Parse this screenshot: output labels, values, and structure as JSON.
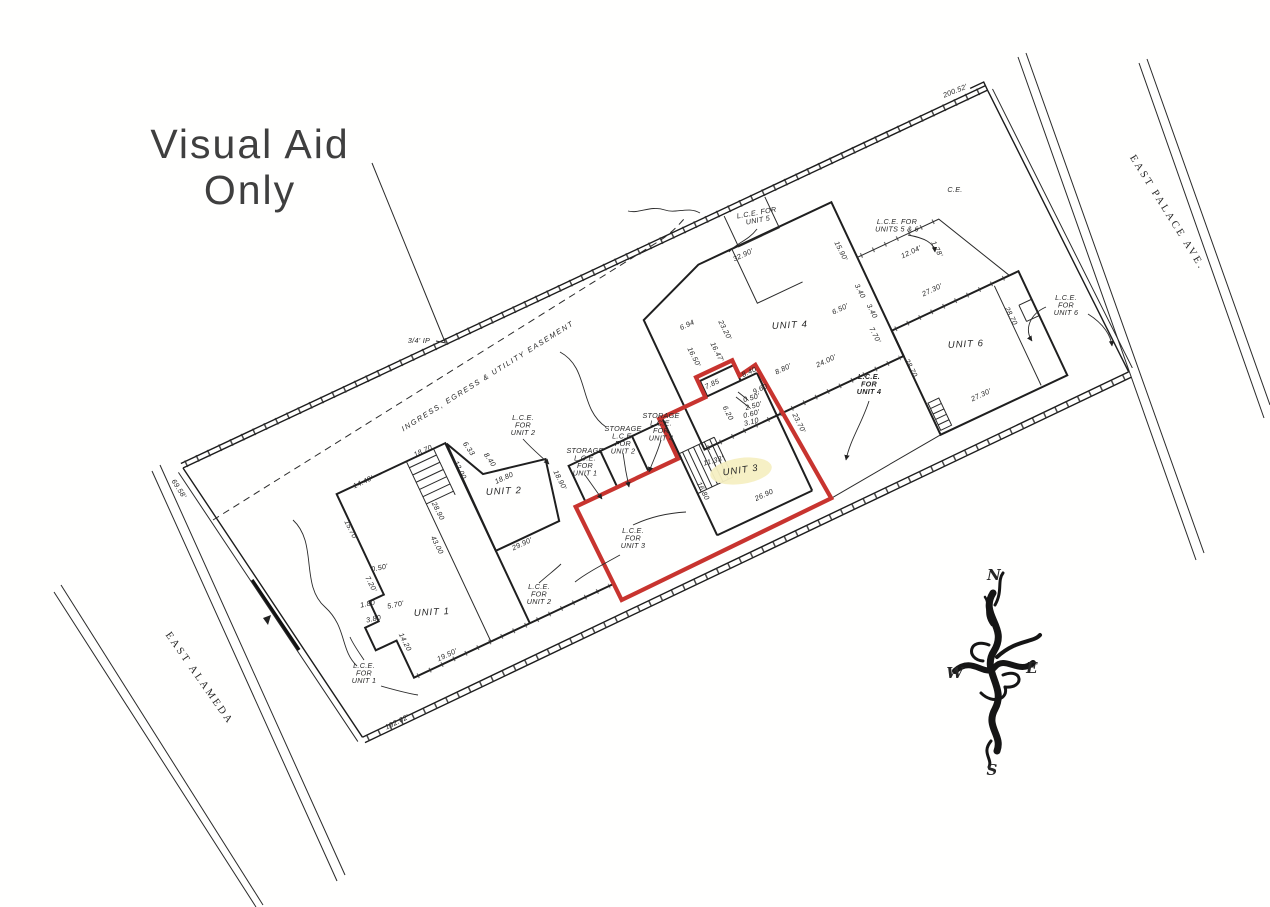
{
  "title": {
    "line1": "Visual Aid",
    "line2": "Only"
  },
  "colors": {
    "red_outline": "#c8342f",
    "unit3_highlight": "#f6efc2",
    "ink": "#1f1f1f"
  },
  "compass": {
    "n": "N",
    "e": "E",
    "s": "S",
    "w": "W"
  },
  "plan": {
    "texts": [
      {
        "n": "label-ce",
        "t": "C.E.",
        "x": 955,
        "y": 192,
        "r": 0,
        "s": 8
      },
      {
        "n": "label-lce-unit5",
        "lines": [
          "L.C.E. FOR",
          "UNIT 5"
        ],
        "x": 757,
        "y": 215,
        "r": -10
      },
      {
        "n": "label-lce-units-5-6",
        "lines": [
          "L.C.E. FOR",
          "UNITS 5 & 6"
        ],
        "x": 897,
        "y": 224,
        "r": 0
      },
      {
        "n": "label-lce-unit6",
        "lines": [
          "L.C.E.",
          "FOR",
          "UNIT 6"
        ],
        "x": 1066,
        "y": 300,
        "r": 0
      },
      {
        "n": "label-lce-unit4",
        "lines": [
          "L.C.E.",
          "FOR",
          "UNIT 4"
        ],
        "x": 869,
        "y": 379,
        "r": 0,
        "cls": "b"
      },
      {
        "n": "label-storage-unit4",
        "lines": [
          "STORAGE",
          "L.C.E.",
          "FOR",
          "UNIT 4"
        ],
        "x": 661,
        "y": 418,
        "r": 0
      },
      {
        "n": "label-storage-unit2",
        "lines": [
          "STORAGE",
          "L.C.E.",
          "FOR",
          "UNIT 2"
        ],
        "x": 623,
        "y": 431,
        "r": 0
      },
      {
        "n": "label-storage-unit1",
        "lines": [
          "STORAGE",
          "L.C.E.",
          "FOR",
          "UNIT 1"
        ],
        "x": 585,
        "y": 453,
        "r": 0
      },
      {
        "n": "label-lce-unit2-upper",
        "lines": [
          "L.C.E.",
          "FOR",
          "UNIT 2"
        ],
        "x": 523,
        "y": 420,
        "r": 0
      },
      {
        "n": "label-lce-unit3",
        "lines": [
          "L.C.E.",
          "FOR",
          "UNIT 3"
        ],
        "x": 633,
        "y": 533,
        "r": 0
      },
      {
        "n": "label-lce-unit2-lower",
        "lines": [
          "L.C.E.",
          "FOR",
          "UNIT 2"
        ],
        "x": 539,
        "y": 589,
        "r": 0
      },
      {
        "n": "label-lce-unit1",
        "lines": [
          "L.C.E.",
          "FOR",
          "UNIT 1"
        ],
        "x": 364,
        "y": 668,
        "r": 0
      },
      {
        "n": "label-unit1",
        "t": "UNIT 1",
        "x": 432,
        "y": 615,
        "r": -3,
        "cls": "u"
      },
      {
        "n": "label-unit2",
        "t": "UNIT 2",
        "x": 504,
        "y": 494,
        "r": -3,
        "cls": "u"
      },
      {
        "n": "label-unit3",
        "t": "UNIT 3",
        "x": 741,
        "y": 473,
        "r": -8,
        "cls": "u"
      },
      {
        "n": "label-unit4",
        "t": "UNIT 4",
        "x": 790,
        "y": 328,
        "r": -3,
        "cls": "u"
      },
      {
        "n": "label-unit6",
        "t": "UNIT 6",
        "x": 966,
        "y": 347,
        "r": -3,
        "cls": "u"
      },
      {
        "n": "label-easement",
        "t": "INGRESS, EGRESS & UTILITY EASEMENT",
        "x": 489,
        "y": 378,
        "r": -32,
        "cls": "e"
      },
      {
        "n": "label-iron-pipe",
        "t": "3/4' IP",
        "x": 419,
        "y": 343,
        "r": 0,
        "s": 8
      },
      {
        "n": "street-east-palace",
        "t": "EAST PALACE AVE.",
        "x": 1165,
        "y": 214,
        "r": 58,
        "cls": "st"
      },
      {
        "n": "street-east-alameda",
        "t": "EAST ALAMEDA",
        "x": 197,
        "y": 680,
        "r": 55,
        "cls": "st"
      },
      {
        "n": "compass-letter-n",
        "t": "N",
        "x": 994,
        "y": 580,
        "r": 0,
        "cls": "cp"
      },
      {
        "n": "compass-letter-w",
        "t": "W",
        "x": 955,
        "y": 678,
        "r": 0,
        "cls": "cp"
      },
      {
        "n": "compass-letter-e",
        "t": "E",
        "x": 1032,
        "y": 673,
        "r": 0,
        "cls": "cp"
      },
      {
        "n": "compass-letter-s",
        "t": "S",
        "x": 992,
        "y": 775,
        "r": 0,
        "cls": "cp"
      },
      {
        "n": "dim-boundary-north",
        "t": "200.52'",
        "x": 956,
        "y": 93,
        "r": -22,
        "s": 8
      },
      {
        "n": "dim-boundary-south",
        "t": "192.62'",
        "x": 398,
        "y": 724,
        "r": -26,
        "s": 8
      },
      {
        "n": "dim-boundary-west",
        "t": "69.58'",
        "x": 177,
        "y": 490,
        "r": 57,
        "s": 8
      },
      {
        "n": "dim",
        "t": "32.90'",
        "x": 744,
        "y": 257,
        "r": -25
      },
      {
        "n": "dim",
        "t": "15.90'",
        "x": 839,
        "y": 252,
        "r": 63
      },
      {
        "n": "dim",
        "t": "3.40",
        "x": 858,
        "y": 292,
        "r": 63,
        "s": 6.5
      },
      {
        "n": "dim",
        "t": "6.50'",
        "x": 841,
        "y": 311,
        "r": -25,
        "s": 6.5
      },
      {
        "n": "dim",
        "t": "3.40",
        "x": 870,
        "y": 312,
        "r": 63,
        "s": 6.5
      },
      {
        "n": "dim",
        "t": "7.70'",
        "x": 873,
        "y": 336,
        "r": 63,
        "s": 6.5
      },
      {
        "n": "dim",
        "t": "12.04'",
        "x": 912,
        "y": 254,
        "r": -25
      },
      {
        "n": "dim",
        "t": "1.78'",
        "x": 935,
        "y": 250,
        "r": 63,
        "s": 6.5
      },
      {
        "n": "dim",
        "t": "27.30'",
        "x": 933,
        "y": 292,
        "r": -25
      },
      {
        "n": "dim",
        "t": "28.70",
        "x": 909,
        "y": 369,
        "r": 63
      },
      {
        "n": "dim",
        "t": "28.70",
        "x": 1009,
        "y": 317,
        "r": 63
      },
      {
        "n": "dim",
        "t": "27.30'",
        "x": 982,
        "y": 397,
        "r": -25
      },
      {
        "n": "dim",
        "t": "6.94",
        "x": 688,
        "y": 327,
        "r": -25,
        "s": 6.5
      },
      {
        "n": "dim",
        "t": "23.20'",
        "x": 723,
        "y": 331,
        "r": 63
      },
      {
        "n": "dim",
        "t": "16.47'",
        "x": 715,
        "y": 353,
        "r": 63,
        "s": 6.5
      },
      {
        "n": "dim",
        "t": "16.50'",
        "x": 692,
        "y": 358,
        "r": 63,
        "s": 6.5
      },
      {
        "n": "dim",
        "t": "24.00'",
        "x": 827,
        "y": 363,
        "r": -25
      },
      {
        "n": "dim",
        "t": "8.80'",
        "x": 784,
        "y": 371,
        "r": -25,
        "s": 6.5
      },
      {
        "n": "dim",
        "t": "8.40",
        "x": 750,
        "y": 374,
        "r": -25,
        "s": 6.5
      },
      {
        "n": "dim",
        "t": "9.60",
        "x": 761,
        "y": 391,
        "r": -25,
        "s": 6.5
      },
      {
        "n": "dim",
        "t": "7.85",
        "x": 713,
        "y": 386,
        "r": -25,
        "s": 6.5
      },
      {
        "n": "dim",
        "t": "0.50'",
        "x": 752,
        "y": 400,
        "r": -15,
        "s": 6.2
      },
      {
        "n": "dim",
        "t": "2.50'",
        "x": 754,
        "y": 408,
        "r": -15,
        "s": 6.2
      },
      {
        "n": "dim",
        "t": "0.60'",
        "x": 752,
        "y": 416,
        "r": -15,
        "s": 6.2
      },
      {
        "n": "dim",
        "t": "3.10",
        "x": 752,
        "y": 424,
        "r": -15,
        "s": 6.2
      },
      {
        "n": "dim",
        "t": "6.20",
        "x": 726,
        "y": 414,
        "r": 63,
        "s": 6.5
      },
      {
        "n": "dim",
        "t": "23.70'",
        "x": 797,
        "y": 424,
        "r": 63
      },
      {
        "n": "dim",
        "t": "11.33'",
        "x": 714,
        "y": 463,
        "r": -15,
        "s": 6.5
      },
      {
        "n": "dim",
        "t": "16.80",
        "x": 701,
        "y": 492,
        "r": 63,
        "s": 6.5
      },
      {
        "n": "dim",
        "t": "26.90",
        "x": 765,
        "y": 497,
        "r": -25,
        "s": 6.5
      },
      {
        "n": "dim",
        "t": "18.70",
        "x": 424,
        "y": 453,
        "r": -25,
        "s": 6.5
      },
      {
        "n": "dim",
        "t": "6.33",
        "x": 467,
        "y": 450,
        "r": 55,
        "s": 6.5
      },
      {
        "n": "dim",
        "t": "12.00",
        "x": 458,
        "y": 471,
        "r": 63,
        "s": 6.5
      },
      {
        "n": "dim",
        "t": "8.40",
        "x": 488,
        "y": 461,
        "r": 55,
        "s": 6.5
      },
      {
        "n": "dim",
        "t": "18.80",
        "x": 505,
        "y": 480,
        "r": -25,
        "s": 6.5
      },
      {
        "n": "dim",
        "t": "18.90'",
        "x": 558,
        "y": 481,
        "r": 63,
        "s": 6.5
      },
      {
        "n": "dim",
        "t": "28.90",
        "x": 436,
        "y": 512,
        "r": 63,
        "s": 6.5
      },
      {
        "n": "dim",
        "t": "29.90'",
        "x": 523,
        "y": 546,
        "r": -25
      },
      {
        "n": "dim",
        "t": "43.00",
        "x": 435,
        "y": 546,
        "r": 63,
        "s": 6.5
      },
      {
        "n": "dim",
        "t": "14.40'",
        "x": 364,
        "y": 484,
        "r": -25
      },
      {
        "n": "dim",
        "t": "15.70'",
        "x": 349,
        "y": 531,
        "r": 63
      },
      {
        "n": "dim",
        "t": "0.50'",
        "x": 380,
        "y": 570,
        "r": -12,
        "s": 6.2
      },
      {
        "n": "dim",
        "t": "7.20'",
        "x": 369,
        "y": 585,
        "r": 63,
        "s": 6.2
      },
      {
        "n": "dim",
        "t": "1.80",
        "x": 368,
        "y": 606,
        "r": -12,
        "s": 6.2
      },
      {
        "n": "dim",
        "t": "5.70'",
        "x": 396,
        "y": 607,
        "r": -12,
        "s": 6.2
      },
      {
        "n": "dim",
        "t": "3.80",
        "x": 374,
        "y": 621,
        "r": -12,
        "s": 6.2
      },
      {
        "n": "dim",
        "t": "14.20",
        "x": 403,
        "y": 643,
        "r": 63,
        "s": 6.5
      },
      {
        "n": "dim",
        "t": "19.50'",
        "x": 448,
        "y": 657,
        "r": -25
      }
    ]
  }
}
